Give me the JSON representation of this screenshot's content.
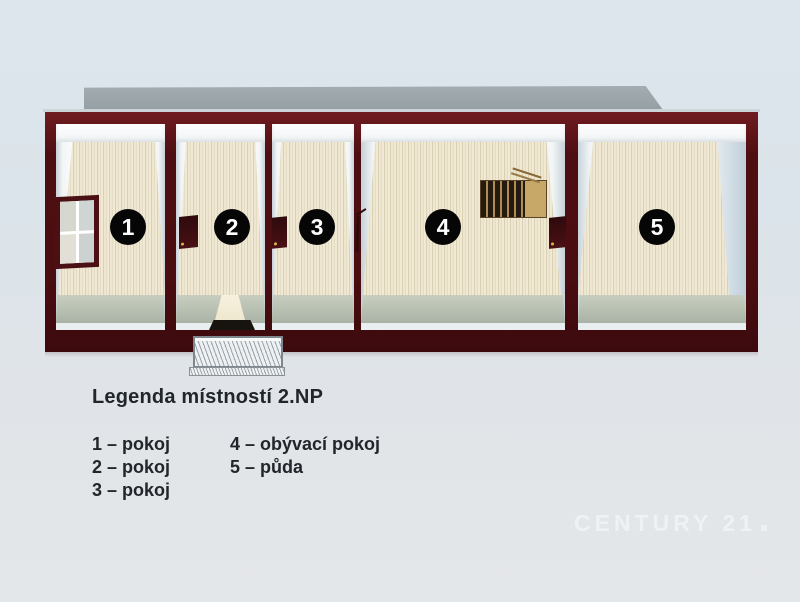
{
  "floorplan": {
    "floor_label": "2.NP",
    "rooms": [
      {
        "number": "1",
        "name": "pokoj"
      },
      {
        "number": "2",
        "name": "pokoj"
      },
      {
        "number": "3",
        "name": "pokoj"
      },
      {
        "number": "4",
        "name": "obývací pokoj"
      },
      {
        "number": "5",
        "name": "půda"
      }
    ],
    "features": {
      "window": "window-icon",
      "stairs": "staircase-icon",
      "balcony": "balcony-railing-icon",
      "door": "door-opening-icon",
      "doormat": "doormat-icon"
    }
  },
  "legend": {
    "title": "Legenda místností 2.NP",
    "columns": [
      {
        "items": [
          "1 – pokoj",
          "2 – pokoj",
          "3 – pokoj"
        ]
      },
      {
        "items": [
          "4 – obývací pokoj",
          "5 – půda"
        ]
      }
    ]
  },
  "watermark": {
    "text": "CENTURY 21"
  },
  "colors": {
    "background": "#dfe7ec",
    "wall": "#4d0e11",
    "floor": "#ece4cd",
    "floor_shadow": "#aab3a7",
    "roof_shadow": "#9aa4a9",
    "badge_bg": "#060606",
    "badge_text": "#ffffff",
    "legend_text": "#21262b",
    "watermark_text": "#f2f7fa"
  }
}
